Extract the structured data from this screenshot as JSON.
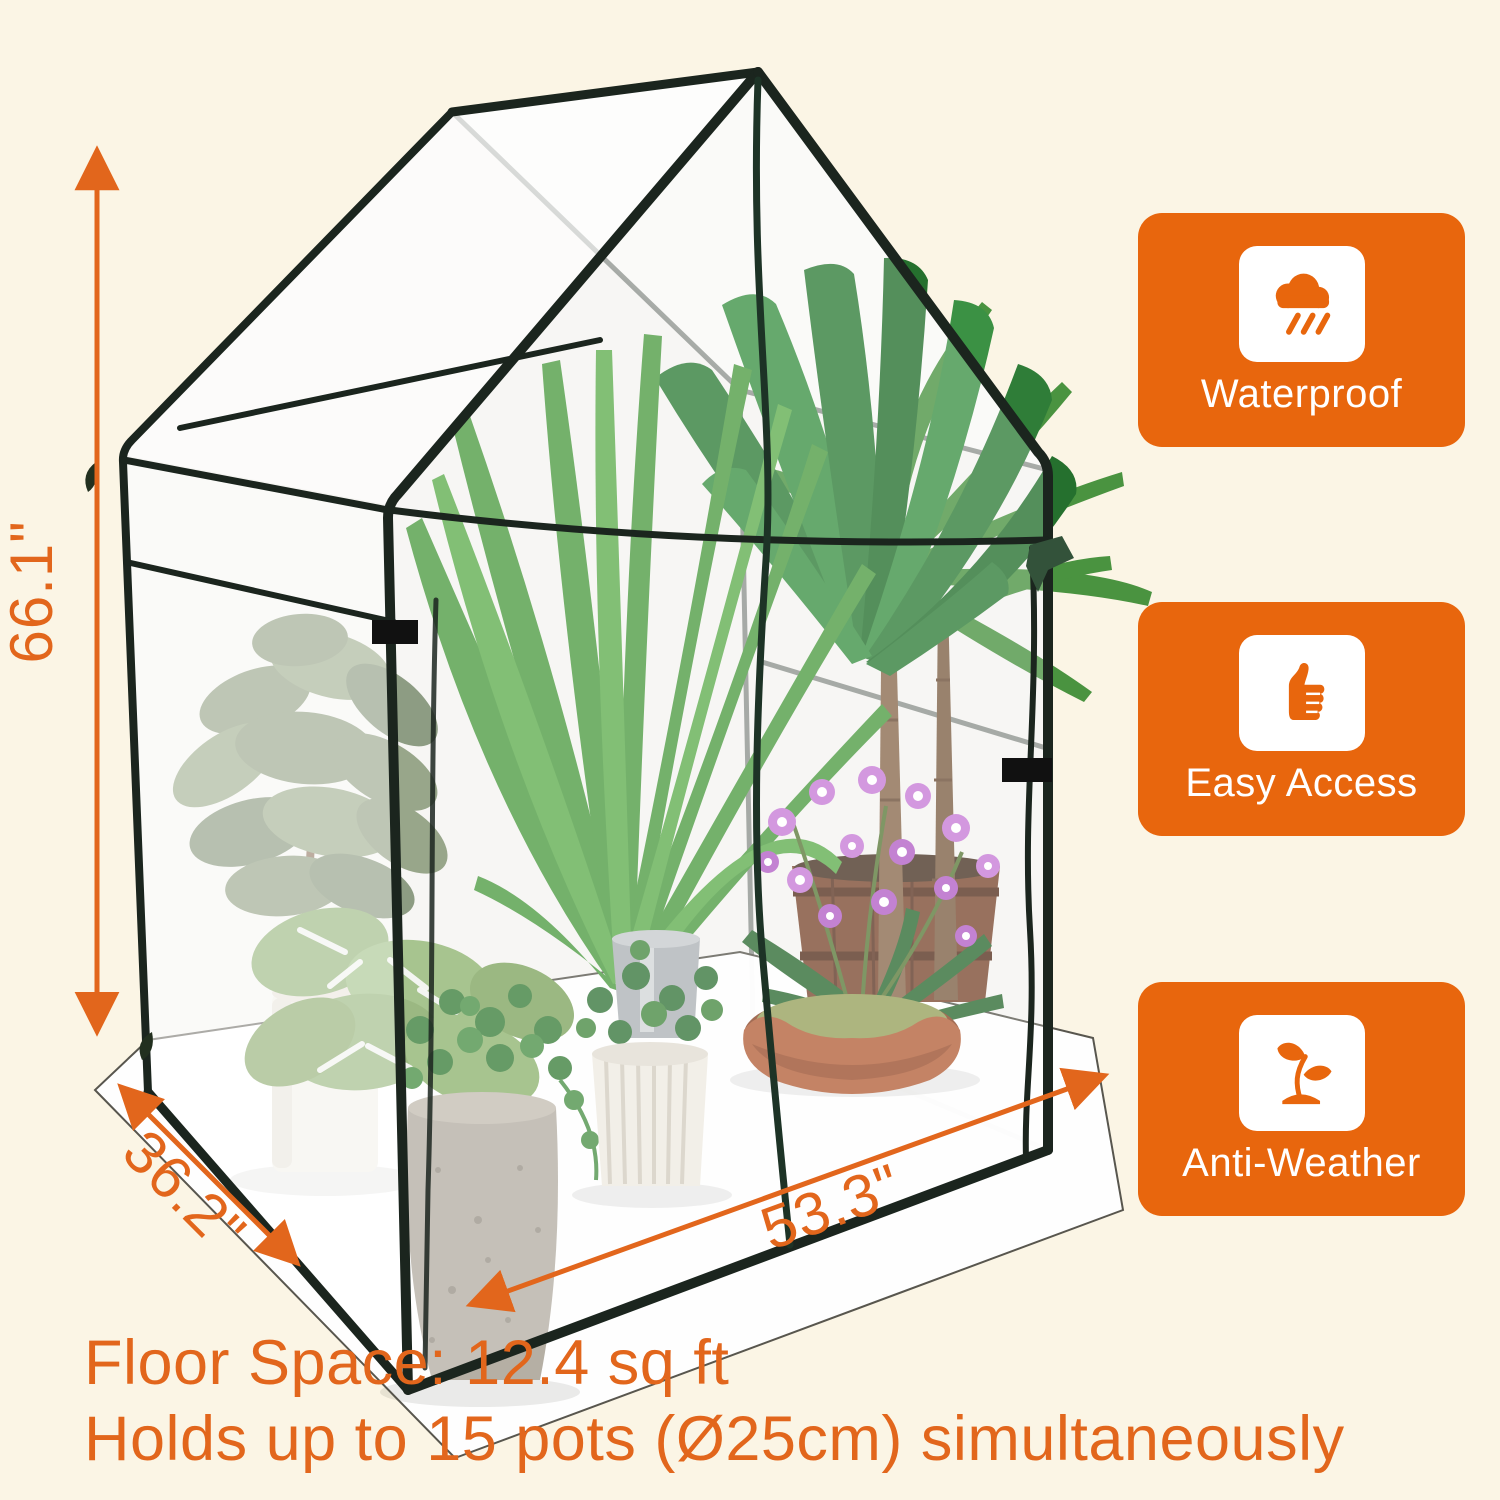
{
  "product": {
    "name": "portable walk-in greenhouse",
    "illustration": "clear PVC house-shaped greenhouse with dark green frame holding potted plants (fig, palms, monstera, ivy, orchids) on a white ground sheet"
  },
  "dimensions": {
    "height_label": "66.1\"",
    "depth_label": "36.2\"",
    "width_label": "53.3\""
  },
  "features": [
    {
      "icon": "rain-cloud-icon",
      "label": "Waterproof"
    },
    {
      "icon": "thumbs-up-icon",
      "label": "Easy Access"
    },
    {
      "icon": "sprout-icon",
      "label": "Anti-Weather"
    }
  ],
  "footer": {
    "line1": "Floor Space: 12.4 sq ft",
    "line2": "Holds up to 15 pots (Ø25cm) simultaneously"
  },
  "colors": {
    "background": "#FBF5E5",
    "accent_orange": "#E2661C",
    "badge_orange": "#E8660D",
    "frame_green": "#1B251E",
    "sheet_white": "#FFFFFF"
  }
}
